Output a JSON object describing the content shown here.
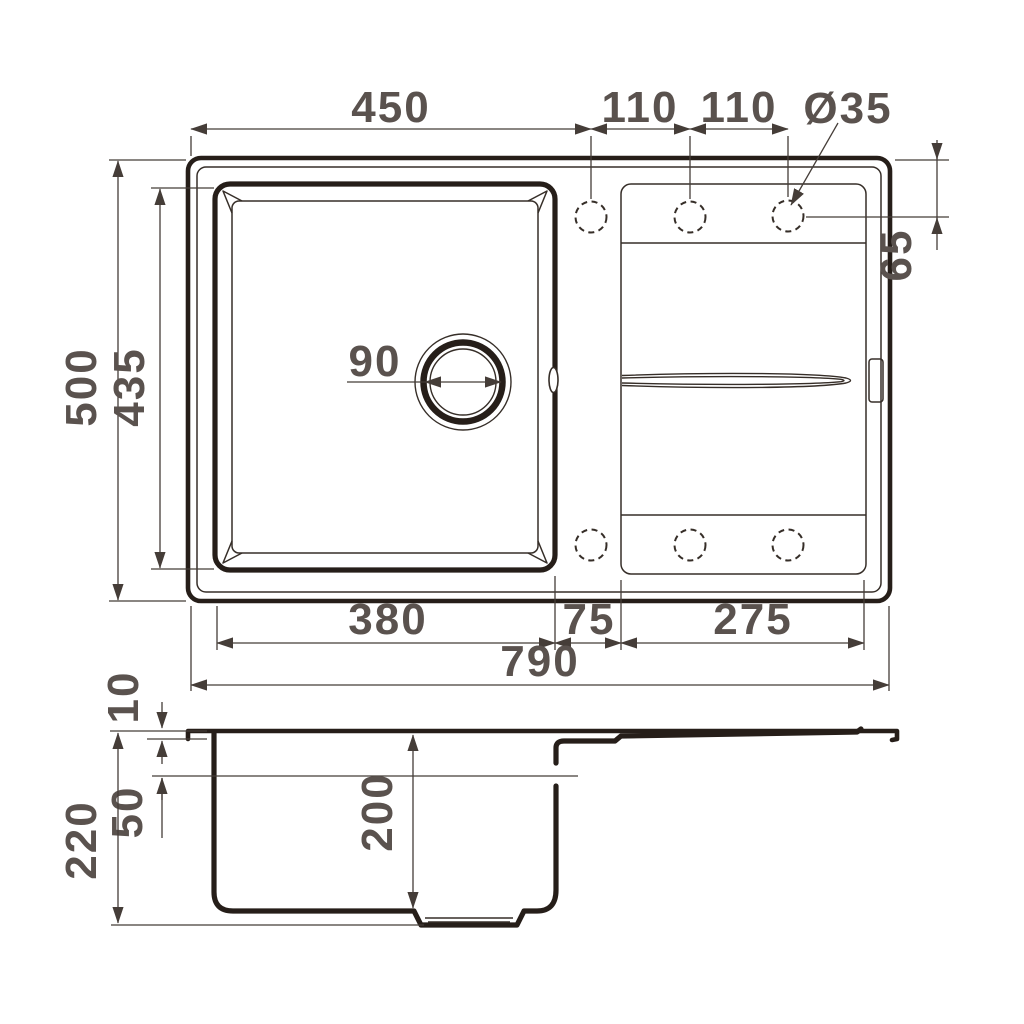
{
  "drawing": {
    "title": "kitchen-sink-dimension-drawing",
    "units": "mm",
    "top_view": {
      "edge_to_first_hole": "450",
      "hole_spacing_a": "110",
      "hole_spacing_b": "110",
      "faucet_hole_diameter": "Ø35",
      "hole_edge_offset": "65",
      "overall_depth": "500",
      "basin_inner_depth": "435",
      "drain_diameter": "90",
      "basin_inner_width": "380",
      "basin_to_drainboard_gap": "75",
      "drainboard_width": "275",
      "overall_width": "790"
    },
    "side_view": {
      "rim_height": "10",
      "overflow_level": "50",
      "bowl_depth": "200",
      "overall_height": "220"
    }
  }
}
